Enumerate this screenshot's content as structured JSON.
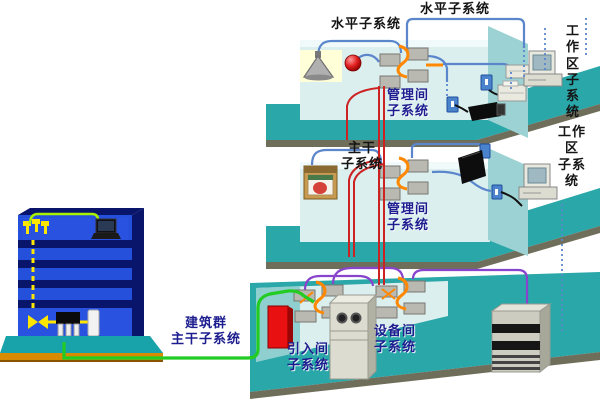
{
  "diagram": {
    "title_hint": "structured-cabling-subsystems",
    "labels": {
      "horizontal_top_1": "水平子系统",
      "horizontal_top_2": "水平子系统",
      "work_area_top": "工作区\n子系统",
      "management_top": "管理间\n子系统",
      "work_area_middle": "工作区\n子系统",
      "backbone_middle": "主干\n子系统",
      "management_middle": "管理间\n子系统",
      "campus_backbone": "建筑群\n主干子系统",
      "entrance_room": "引入间\n子系统",
      "equipment_room": "设备间\n子系统"
    },
    "colors": {
      "floor_teal": "#2aa7a8",
      "floor_edge": "#6e6e5a",
      "wall_light": "#dcefef",
      "wall_accent": "#8fcfcf",
      "partition": "#9dd2d4",
      "building_blue": "#2450dc",
      "building_dark": "#08156b",
      "base_teal": "#18a3ab",
      "ground_orange": "#d88a00",
      "cable_blue": "#5b86cc",
      "cable_red": "#cc2222",
      "cable_green": "#22cc22",
      "cable_purple": "#8844cc",
      "cable_orange": "#ff8800",
      "cable_yellow": "#ffe600",
      "label_dark": "#141414",
      "label_navy": "#1d1d8f"
    },
    "icons": [
      "ceiling-lamp-icon",
      "alarm-bell-icon",
      "patch-panel-icon",
      "wall-outlet-icon",
      "surveillance-camera-icon",
      "desktop-computer-icon",
      "printer-icon",
      "fax-icon",
      "wall-display-icon",
      "hose-cabinet-icon",
      "building-icon",
      "laptop-icon",
      "sprinkler-icon",
      "valve-icon",
      "rack-legs-icon",
      "tank-icon",
      "protector-box-icon",
      "equipment-cabinet-icon",
      "server-rack-icon"
    ]
  }
}
